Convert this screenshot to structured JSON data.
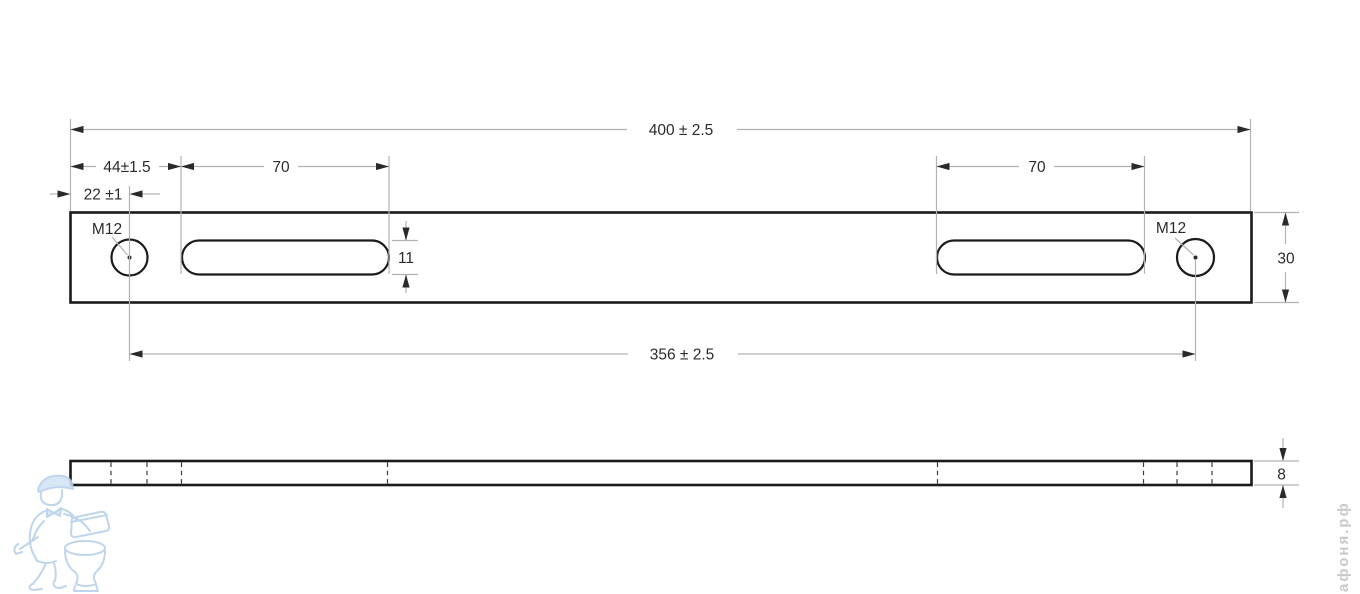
{
  "drawing": {
    "dims": {
      "overall_length": "400 ± 2.5",
      "end_to_slot": "44±1.5",
      "end_to_hole_center": "22 ±1",
      "slot_length_left": "70",
      "slot_length_right": "70",
      "slot_width": "11",
      "plate_width": "30",
      "hole_spacing": "356 ± 2.5",
      "plate_thickness": "8",
      "thread_left": "M12",
      "thread_right": "M12"
    },
    "colors": {
      "part_outline": "#1b1b1b",
      "dimension_lines": "#b2b2b2",
      "dimension_text": "#2b2b2b",
      "watermark_blue": "#b7d1ea",
      "watermark_gray": "#c9c9c9"
    }
  },
  "watermark": {
    "site": "афоня.рф"
  }
}
